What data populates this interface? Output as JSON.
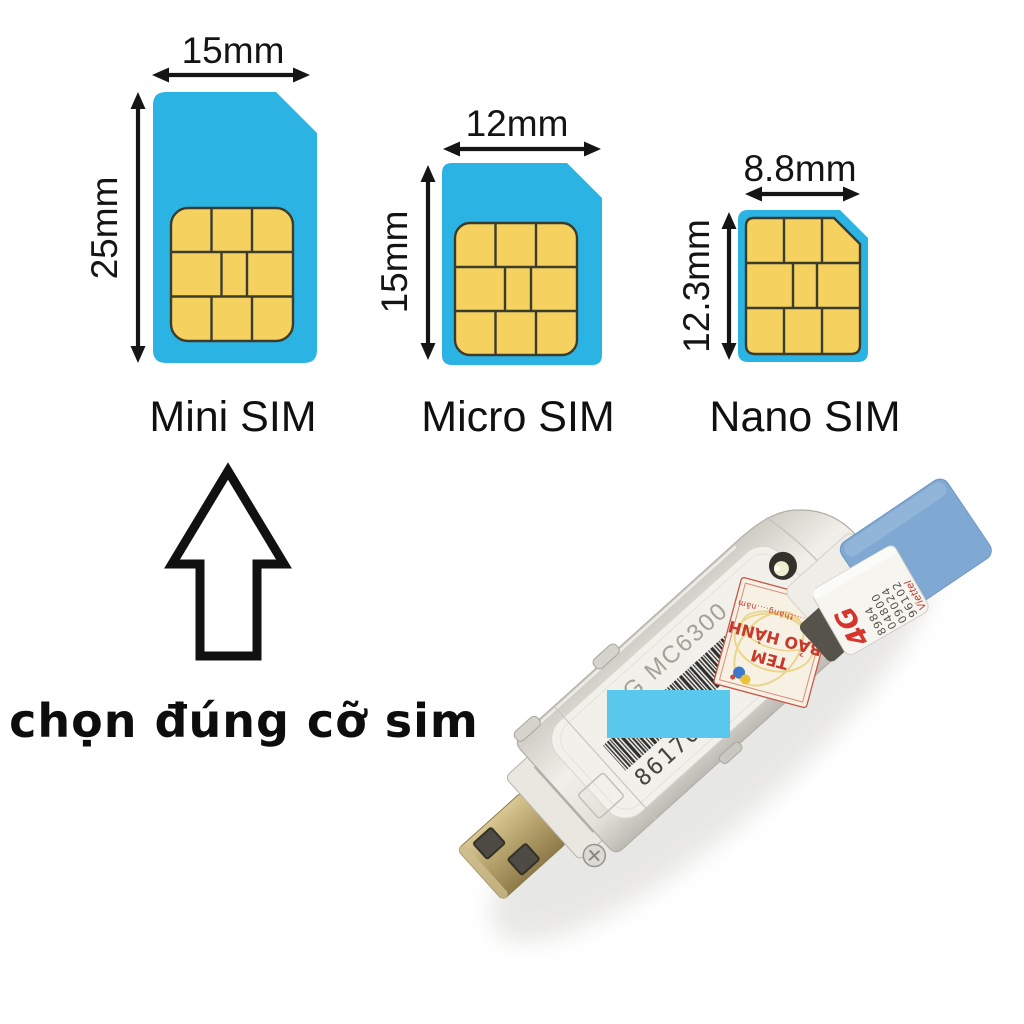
{
  "diagram": {
    "cards": [
      {
        "name": "Mini SIM",
        "width_label": "15mm",
        "height_label": "25mm"
      },
      {
        "name": "Micro SIM",
        "width_label": "12mm",
        "height_label": "15mm"
      },
      {
        "name": "Nano SIM",
        "width_label": "8.8mm",
        "height_label": "12.3mm"
      }
    ],
    "colors": {
      "card_blue": "#2bb3e4",
      "chip_gold": "#f5d15f",
      "chip_line": "#3c3c2c"
    }
  },
  "caption": {
    "text": "chọn đúng cỡ sim"
  },
  "photo": {
    "device_model_text": "4G MC6300",
    "serial_visible_left": "86170",
    "serial_visible_right": "378",
    "warranty_sticker": {
      "line1": "TEM",
      "line2": "BẢO HÀNH",
      "line3": "Ngày....tháng....năm"
    },
    "sim_label": {
      "logo": "4G",
      "carrier": "Viettel",
      "iccid_lines": [
        "8984",
        "04800",
        "09024",
        "96102"
      ]
    },
    "censor_color": "#5ac7ed"
  }
}
